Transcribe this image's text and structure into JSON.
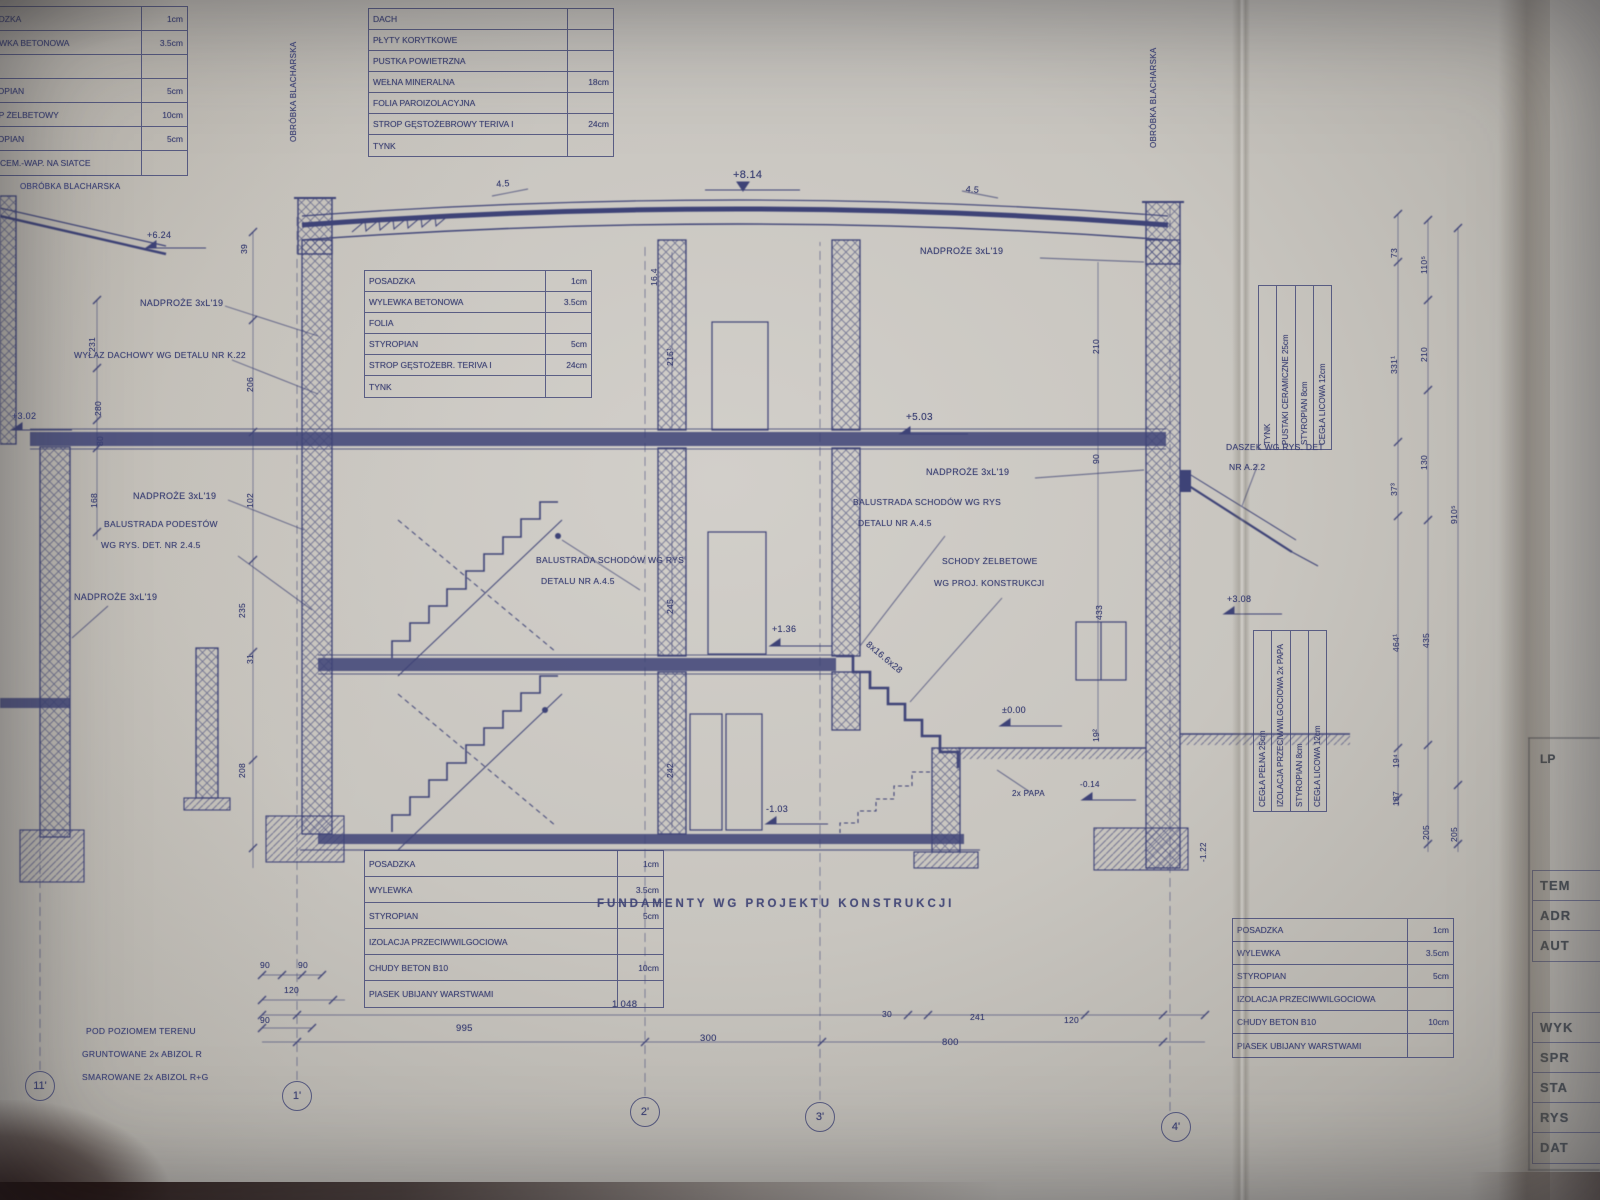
{
  "colors": {
    "ink": "#3d4274",
    "paper": "#c8c5bf"
  },
  "tables": {
    "top_left": {
      "rows": [
        {
          "label": "POSADZKA",
          "value": "1cm"
        },
        {
          "label": "WYLEWKA BETONOWA",
          "value": "3.5cm"
        },
        {
          "label": "FOLIA",
          "value": ""
        },
        {
          "label": "STYROPIAN",
          "value": "5cm"
        },
        {
          "label": "STROP ŻELBETOWY",
          "value": "10cm"
        },
        {
          "label": "STYROPIAN",
          "value": "5cm"
        },
        {
          "label": "TYNK CEM.-WAP. NA SIATCE",
          "value": ""
        }
      ]
    },
    "roof": {
      "rows": [
        {
          "label": "DACH",
          "value": ""
        },
        {
          "label": "PŁYTY KORYTKOWE",
          "value": ""
        },
        {
          "label": "PUSTKA POWIETRZNA",
          "value": ""
        },
        {
          "label": "WEŁNA MINERALNA",
          "value": "18cm"
        },
        {
          "label": "FOLIA PAROIZOLACYJNA",
          "value": ""
        },
        {
          "label": "STROP GĘSTOŻEBROWY TERIVA I",
          "value": "24cm"
        },
        {
          "label": "TYNK",
          "value": ""
        }
      ]
    },
    "floor1": {
      "rows": [
        {
          "label": "POSADZKA",
          "value": "1cm"
        },
        {
          "label": "WYLEWKA BETONOWA",
          "value": "3.5cm"
        },
        {
          "label": "FOLIA",
          "value": ""
        },
        {
          "label": "STYROPIAN",
          "value": "5cm"
        },
        {
          "label": "STROP GĘSTOŻEBR. TERIVA I",
          "value": "24cm"
        },
        {
          "label": "TYNK",
          "value": ""
        }
      ]
    },
    "ground": {
      "rows": [
        {
          "label": "POSADZKA",
          "value": "1cm"
        },
        {
          "label": "WYLEWKA",
          "value": "3.5cm"
        },
        {
          "label": "STYROPIAN",
          "value": "5cm"
        },
        {
          "label": "IZOLACJA PRZECIWWILGOCIOWA",
          "value": ""
        },
        {
          "label": "CHUDY BETON B10",
          "value": "10cm"
        },
        {
          "label": "PIASEK UBIJANY WARSTWAMI",
          "value": ""
        }
      ]
    },
    "ground_right": {
      "rows": [
        {
          "label": "POSADZKA",
          "value": "1cm"
        },
        {
          "label": "WYLEWKA",
          "value": "3.5cm"
        },
        {
          "label": "STYROPIAN",
          "value": "5cm"
        },
        {
          "label": "IZOLACJA PRZECIWWILGOCIOWA",
          "value": ""
        },
        {
          "label": "CHUDY BETON B10",
          "value": "10cm"
        },
        {
          "label": "PIASEK UBIJANY WARSTWAMI",
          "value": ""
        }
      ]
    },
    "wall_upper": {
      "cols": [
        "TYNK",
        "PUSTAKI CERAMICZNE 25cm",
        "STYROPIAN 8cm",
        "CEGŁA LICOWA 12cm"
      ]
    },
    "wall_lower": {
      "cols": [
        "CEGŁA PEŁNA 25cm",
        "IZOLACJA PRZECIWWILGOCIOWA 2x PAPA",
        "STYROPIAN 8cm",
        "CEGŁA LICOWA 12cm"
      ]
    }
  },
  "annotations": {
    "elev_ridge": "+8.14",
    "slope_left": "4.5",
    "slope_right": "4.5",
    "nadproze_tr": "NADPROŻE 3xL'19",
    "nadproze_tl": "NADPROŻE 3xL'19",
    "nadproze_mr": "NADPROŻE 3xL'19",
    "nadproze_ml": "NADPROŻE 3xL'19",
    "nadproze_bl": "NADPROŻE 3xL'19",
    "wylaz": "WYŁAZ DACHOWY WG DETALU NR K.22",
    "elev_6": "+6.24",
    "elev_3l": "+3.02",
    "elev_5": "+5.03",
    "elev_136": "+1.36",
    "elev_0": "±0.00",
    "elev_m1": "-1.03",
    "elev_308": "+3.08",
    "elev_m014": "-0.14",
    "elev_m122": "-1.22",
    "balustrada_podestow_1": "BALUSTRADA PODESTÓW",
    "balustrada_podestow_2": "WG RYS. DET. NR 2.4.5",
    "balustrada_c1": "BALUSTRADA SCHODÓW WG RYS",
    "balustrada_c2": "DETALU NR A.4.5",
    "balustrada_r1": "BALUSTRADA SCHODÓW WG RYS",
    "balustrada_r2": "DETALU NR A.4.5",
    "schody1": "SCHODY ŻELBETOWE",
    "schody2": "WG PROJ. KONSTRUKCJI",
    "daszek1": "DASZEK WG RYS. DET",
    "daszek2": "NR A.2.2",
    "papa": "2x PAPA",
    "stopnie": "8x16.6x28",
    "fundamenty": "FUNDAMENTY WG PROJEKTU KONSTRUKCJI",
    "abizol1": "POD POZIOMEM TERENU",
    "abizol2": "GRUNTOWANE 2x ABIZOL R",
    "abizol3": "SMAROWANE 2x ABIZOL R+G",
    "obrobka_l": "OBRÓBKA BLACHARSKA",
    "obrobka_vl": "OBRÓBKA BLACHARSKA",
    "obrobka_vr": "OBRÓBKA BLACHARSKA"
  },
  "dims": {
    "bottom": [
      "1 048",
      "995",
      "300",
      "800",
      "30",
      "241",
      "120",
      "90",
      "90",
      "120",
      "90"
    ],
    "right": [
      "73",
      "110⁵",
      "210",
      "331¹",
      "130",
      "37³",
      "464¹",
      "435",
      "910⁵",
      "187",
      "19⁴",
      "205",
      "205"
    ],
    "left": [
      "39",
      "206",
      "231",
      "280",
      "102",
      "235",
      "31",
      "208",
      "80",
      "168"
    ],
    "center": [
      "215¹",
      "16.4",
      "245",
      "242",
      "210",
      "90",
      "433",
      "19²"
    ]
  },
  "axes": [
    "11'",
    "1'",
    "2'",
    "3'",
    "4'"
  ],
  "title_block": {
    "lp": "LP",
    "upper": [
      "TEM",
      "ADR",
      "AUT"
    ],
    "lower": [
      "WYK",
      "SPR",
      "STA",
      "RYS",
      "DAT"
    ]
  }
}
